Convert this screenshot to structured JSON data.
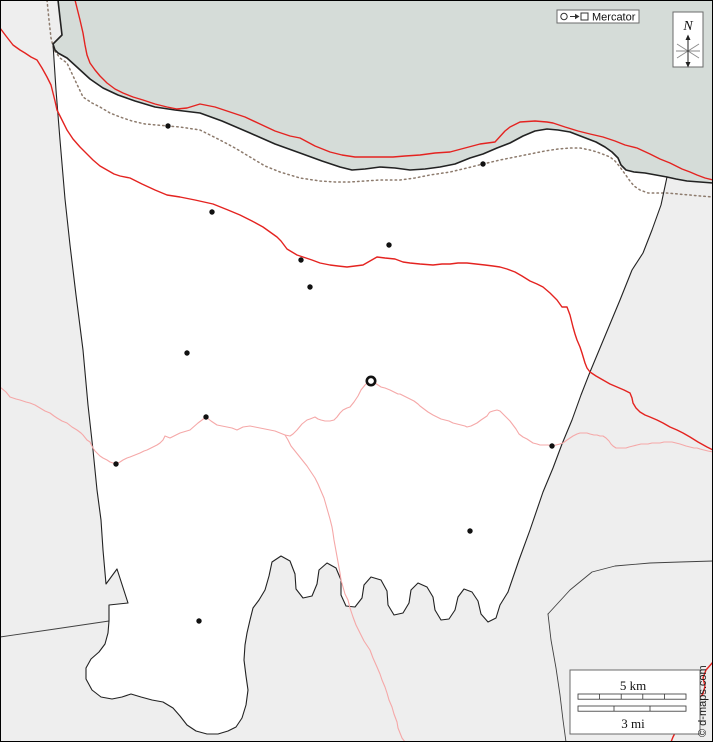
{
  "map": {
    "projection_badge": {
      "label": "Mercator"
    },
    "compass": {
      "label": "N"
    },
    "scale_bar": {
      "km_label": "5 km",
      "mi_label": "3 mi"
    },
    "credit": "© d-maps.com",
    "colors": {
      "sea": "#d5dcd8",
      "land": "#ffffff",
      "outside": "#eeeeee",
      "border": "#222222",
      "road": "#e42320",
      "river": "#f5a8a8",
      "railway": "#8d7b6d",
      "town": "#111111"
    },
    "towns": [
      {
        "x": 168,
        "y": 126
      },
      {
        "x": 483,
        "y": 164
      },
      {
        "x": 212,
        "y": 212
      },
      {
        "x": 389,
        "y": 245
      },
      {
        "x": 301,
        "y": 260
      },
      {
        "x": 310,
        "y": 287
      },
      {
        "x": 187,
        "y": 353
      },
      {
        "x": 206,
        "y": 417
      },
      {
        "x": 116,
        "y": 464
      },
      {
        "x": 552,
        "y": 446
      },
      {
        "x": 470,
        "y": 531
      },
      {
        "x": 199,
        "y": 621
      }
    ],
    "capital": {
      "x": 371,
      "y": 381
    }
  }
}
